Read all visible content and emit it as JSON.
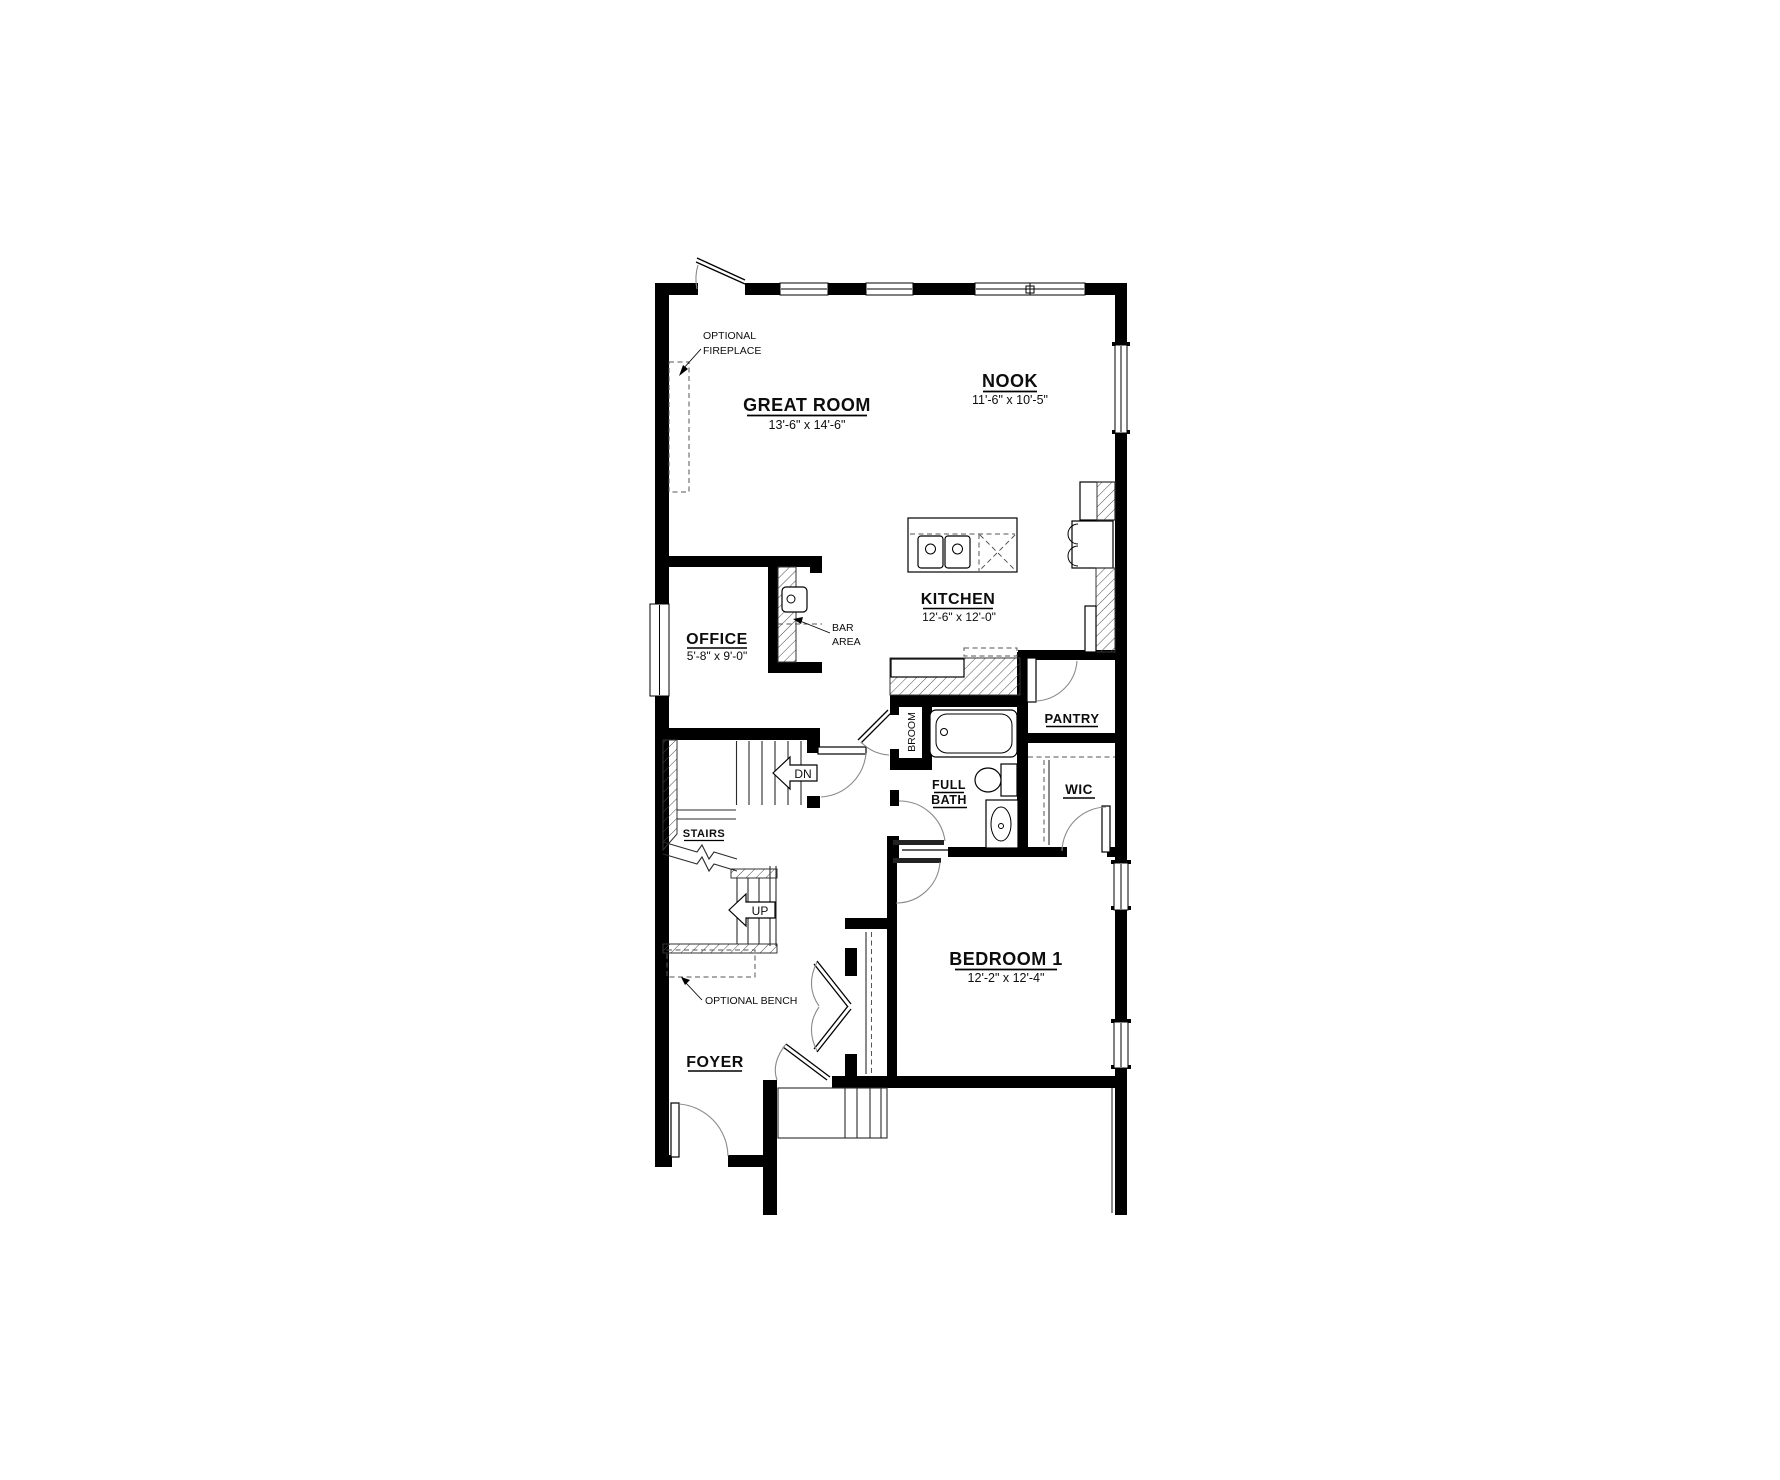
{
  "floor_plan": {
    "rooms": {
      "great_room": {
        "name": "GREAT ROOM",
        "dimensions": "13'-6\" x 14'-6\""
      },
      "nook": {
        "name": "NOOK",
        "dimensions": "11'-6\" x 10'-5\""
      },
      "kitchen": {
        "name": "KITCHEN",
        "dimensions": "12'-6\" x 12'-0\""
      },
      "office": {
        "name": "OFFICE",
        "dimensions": "5'-8\" x 9'-0\""
      },
      "bedroom_1": {
        "name": "BEDROOM 1",
        "dimensions": "12'-2\" x 12'-4\""
      },
      "foyer": {
        "name": "FOYER"
      },
      "pantry": {
        "name": "PANTRY"
      },
      "wic": {
        "name": "WIC"
      },
      "full_bath": {
        "name_line_1": "FULL",
        "name_line_2": "BATH"
      },
      "broom_closet": {
        "name": "BROOM"
      },
      "stairs": {
        "name": "STAIRS"
      }
    },
    "annotations": {
      "optional_fireplace": {
        "line_1": "OPTIONAL",
        "line_2": "FIREPLACE"
      },
      "bar_area": {
        "line_1": "BAR",
        "line_2": "AREA"
      },
      "optional_bench": "OPTIONAL BENCH",
      "stair_direction_down": "DN",
      "stair_direction_up": "UP"
    },
    "colors": {
      "wall": "#000000",
      "background": "#ffffff",
      "door_swing": "#8a8a8a"
    }
  }
}
